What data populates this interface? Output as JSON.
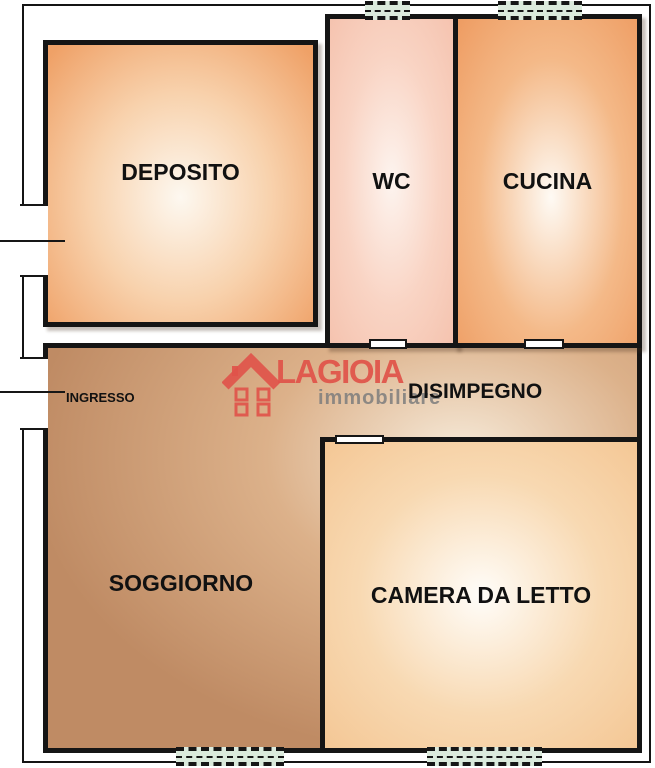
{
  "brand": {
    "name": "LAGIOIA",
    "tagline": "immobiliare"
  },
  "rooms": {
    "deposito": "DEPOSITO",
    "wc": "WC",
    "cucina": "CUCINA",
    "disimpegno": "DISIMPEGNO",
    "ingresso": "INGRESSO",
    "soggiorno": "SOGGIORNO",
    "camera_da_letto": "CAMERA DA LETTO"
  },
  "colors": {
    "wall": "#151515",
    "room_orange": "#EE9C62",
    "room_pink": "#F5C3AF",
    "hall_tan": "#BF8B64",
    "room_peach": "#F4C795",
    "window_green": "#DBEADC",
    "logo_red": "#E05249",
    "tagline_gray": "#7D7D7D"
  }
}
